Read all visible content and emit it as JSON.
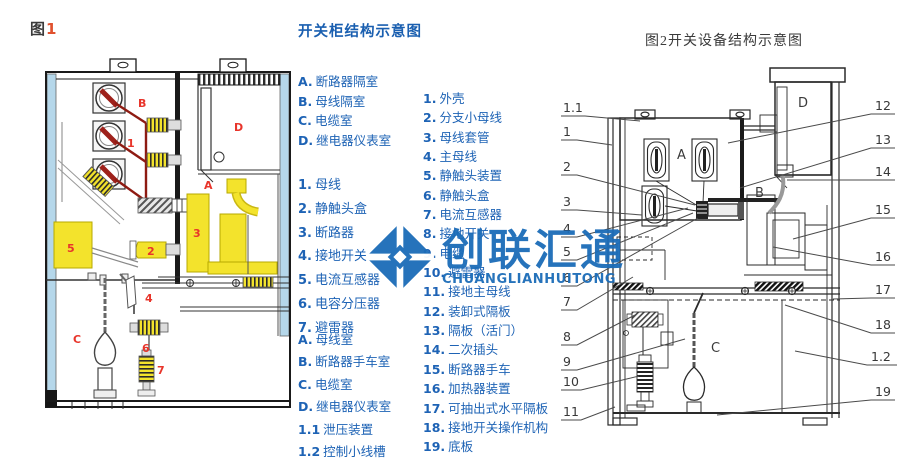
{
  "colors": {
    "accent_blue": "#1e63b5",
    "title_blue": "#1a5fb0",
    "label_red": "#e8352b",
    "wire_dark_red": "#8e1b12",
    "part_yellow": "#f3e32c",
    "panel_light_blue": "#b5d7ea",
    "watermark_blue": "#1b6cb8"
  },
  "figure1": {
    "caption": {
      "prefix": "图",
      "number": "1"
    },
    "compartments": {
      "a": "A",
      "b": "B",
      "c": "C",
      "d": "D"
    },
    "parts": {
      "p1": "1",
      "p2": "2",
      "p3": "3",
      "p4": "4",
      "p5": "5",
      "p6": "6",
      "p7": "7"
    }
  },
  "legend": {
    "title": "开关柜结构示意图",
    "groups": {
      "fig1_compartments": [
        {
          "key": "A.",
          "text": "断路器隔室"
        },
        {
          "key": "B.",
          "text": "母线隔室"
        },
        {
          "key": "C.",
          "text": "电缆室"
        },
        {
          "key": "D.",
          "text": "继电器仪表室"
        }
      ],
      "fig1_parts": [
        {
          "key": "1.",
          "text": "母线"
        },
        {
          "key": "2.",
          "text": "静触头盒"
        },
        {
          "key": "3.",
          "text": "断路器"
        },
        {
          "key": "4.",
          "text": "接地开关"
        },
        {
          "key": "5.",
          "text": "电流互感器"
        },
        {
          "key": "6.",
          "text": "电容分压器"
        },
        {
          "key": "7.",
          "text": "避雷器"
        }
      ],
      "fig2_compartments": [
        {
          "key": "A.",
          "text": "母线室"
        },
        {
          "key": "B.",
          "text": "断路器手车室"
        },
        {
          "key": "C.",
          "text": "电缆室"
        },
        {
          "key": "D.",
          "text": "继电器仪表室"
        },
        {
          "key": "1.1",
          "text": "泄压装置"
        },
        {
          "key": "1.2",
          "text": "控制小线槽"
        }
      ],
      "fig2_parts": [
        {
          "key": "1.",
          "text": "外壳"
        },
        {
          "key": "2.",
          "text": "分支小母线"
        },
        {
          "key": "3.",
          "text": "母线套管"
        },
        {
          "key": "4.",
          "text": "主母线"
        },
        {
          "key": "5.",
          "text": "静触头装置"
        },
        {
          "key": "6.",
          "text": "静触头盒"
        },
        {
          "key": "7.",
          "text": "电流互感器"
        },
        {
          "key": "8.",
          "text": "接地开关"
        },
        {
          "key": "9.",
          "text": "电缆"
        },
        {
          "key": "10.",
          "text": "避雷器"
        },
        {
          "key": "11.",
          "text": "接地主母线"
        },
        {
          "key": "12.",
          "text": "装卸式隔板"
        },
        {
          "key": "13.",
          "text": "隔板（活门）"
        },
        {
          "key": "14.",
          "text": "二次插头"
        },
        {
          "key": "15.",
          "text": "断路器手车"
        },
        {
          "key": "16.",
          "text": "加热器装置"
        },
        {
          "key": "17.",
          "text": "可抽出式水平隔板"
        },
        {
          "key": "18.",
          "text": "接地开关操作机构"
        },
        {
          "key": "19.",
          "text": "底板"
        }
      ]
    }
  },
  "figure2": {
    "title": "图2开关设备结构示意图",
    "compartments": {
      "a": "A",
      "b": "B",
      "c": "C",
      "d": "D"
    },
    "left_callouts": [
      "1.1",
      "1",
      "2",
      "3",
      "4",
      "5",
      "6",
      "7",
      "8",
      "9",
      "10",
      "11"
    ],
    "right_callouts": [
      "12",
      "13",
      "14",
      "15",
      "16",
      "17",
      "18",
      "1.2",
      "19"
    ]
  },
  "watermark": {
    "name": "创联汇通",
    "romanized": "CHUANGLIANHUITONG"
  }
}
